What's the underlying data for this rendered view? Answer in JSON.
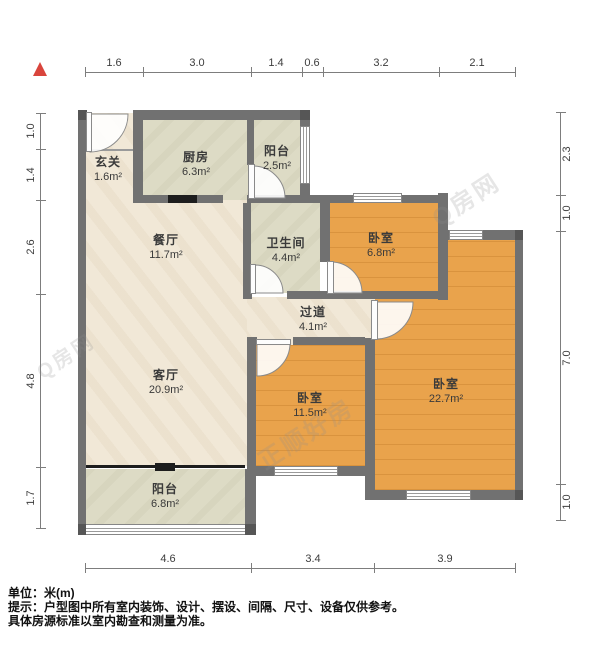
{
  "plan_title": "户型图",
  "north_arrow": "north-indicator",
  "rooms": [
    {
      "id": "entry",
      "name": "玄关",
      "area": "1.6m²"
    },
    {
      "id": "kitchen",
      "name": "厨房",
      "area": "6.3m²"
    },
    {
      "id": "balcony-top",
      "name": "阳台",
      "area": "2.5m²"
    },
    {
      "id": "dining",
      "name": "餐厅",
      "area": "11.7m²"
    },
    {
      "id": "bathroom",
      "name": "卫生间",
      "area": "4.4m²"
    },
    {
      "id": "bedroom-small",
      "name": "卧室",
      "area": "6.8m²"
    },
    {
      "id": "hallway",
      "name": "过道",
      "area": "4.1m²"
    },
    {
      "id": "living",
      "name": "客厅",
      "area": "20.9m²"
    },
    {
      "id": "bedroom-mid",
      "name": "卧室",
      "area": "11.5m²"
    },
    {
      "id": "bedroom-large",
      "name": "卧室",
      "area": "22.7m²"
    },
    {
      "id": "balcony-bottom",
      "name": "阳台",
      "area": "6.8m²"
    }
  ],
  "dimensions": {
    "top": [
      "1.6",
      "3.0",
      "1.4",
      "0.6",
      "3.2",
      "2.1"
    ],
    "left": [
      "1.0",
      "1.4",
      "2.6",
      "4.8",
      "1.7"
    ],
    "right": [
      "2.3",
      "1.0",
      "7.0",
      "1.0"
    ],
    "bottom": [
      "4.6",
      "3.4",
      "3.9"
    ]
  },
  "watermarks": [
    "正顺好房",
    "Q房网"
  ],
  "footer": {
    "unit_line": "单位：米(m)",
    "tip_line": "提示：户型图中所有室内装饰、设计、摆设、间隔、尺寸、设备仅供参考。",
    "tip_line2": "具体房源标准以室内勘查和测量为准。"
  },
  "colors": {
    "wall": "#717171",
    "wood_floor": "#e9a34c",
    "tile_floor": "#dddbc5",
    "marble_floor": "#f1e8d7",
    "north_arrow": "#d9453c",
    "black_divider": "#1d1d1d"
  }
}
